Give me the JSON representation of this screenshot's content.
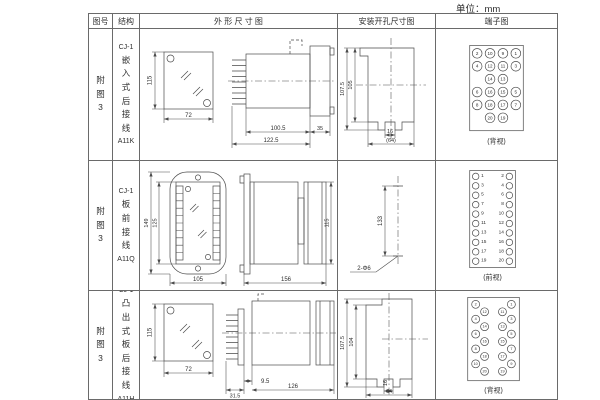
{
  "unit_label": "单位：mm",
  "headers": {
    "fig_no": "图号",
    "structure": "结构",
    "outline": "外 形 尺 寸 图",
    "mounting": "安装开孔尺寸图",
    "terminal": "端子图"
  },
  "rows": [
    {
      "fig_no": "附图3",
      "model": "CJ-1",
      "structure": "嵌入式后接线",
      "code": "A11K",
      "outline": {
        "front_h": "115",
        "front_w": "72",
        "side_body": "100.5",
        "side_total": "122.5",
        "side_flange": "35"
      },
      "mounting": {
        "outer_h": "107.5",
        "inner_h": "105",
        "notch": "16",
        "width": "(64)"
      },
      "terminal": {
        "view": "(背视)",
        "grid": [
          [
            "2",
            "10",
            "9",
            "1"
          ],
          [
            "4",
            "12",
            "11",
            "3"
          ],
          [
            "",
            "14",
            "13",
            ""
          ],
          [
            "6",
            "16",
            "15",
            "5"
          ],
          [
            "8",
            "18",
            "17",
            "7"
          ],
          [
            "",
            "20",
            "19",
            ""
          ]
        ]
      }
    },
    {
      "fig_no": "附图3",
      "model": "CJ-1",
      "structure": "板前接线",
      "code": "A11Q",
      "outline": {
        "front_outer_h": "149",
        "front_inner_h": "125",
        "front_w": "105",
        "side_len": "156",
        "side_h": "115"
      },
      "mounting": {
        "span": "133",
        "holes": "2-Φ6"
      },
      "terminal": {
        "view": "(前视)",
        "pairs": [
          [
            "1",
            "2"
          ],
          [
            "3",
            "4"
          ],
          [
            "5",
            "6"
          ],
          [
            "7",
            "8"
          ],
          [
            "9",
            "10"
          ],
          [
            "11",
            "12"
          ],
          [
            "13",
            "14"
          ],
          [
            "15",
            "16"
          ],
          [
            "17",
            "18"
          ],
          [
            "19",
            "20"
          ]
        ]
      }
    },
    {
      "fig_no": "附图3",
      "model": "CJ-1",
      "structure": "凸出式板后接线",
      "code": "A11H",
      "outline": {
        "front_h": "115",
        "front_w": "72",
        "side_pins": "31.5",
        "side_offset": "9.5",
        "side_len": "126"
      },
      "mounting": {
        "outer_h": "107.5",
        "inner_h": "104",
        "notch": "16",
        "width": "64"
      },
      "terminal": {
        "view": "(背视)",
        "left_outer": [
          "2",
          "4",
          "6",
          "8",
          "10"
        ],
        "left_inner": [
          "12",
          "14",
          "16",
          "18",
          "20"
        ],
        "right_inner": [
          "11",
          "13",
          "15",
          "17",
          "19"
        ],
        "right_outer": [
          "1",
          "3",
          "5",
          "7",
          "9"
        ]
      }
    }
  ]
}
